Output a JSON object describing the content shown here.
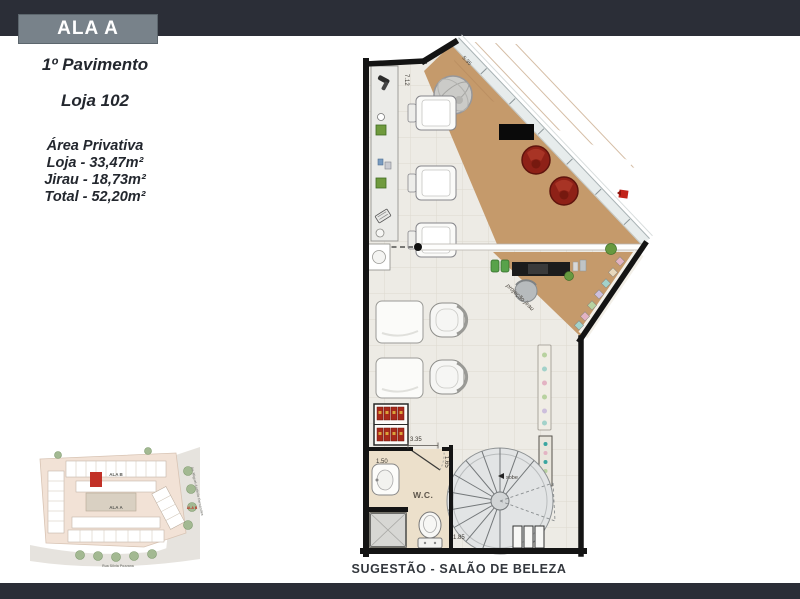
{
  "header": {
    "ala_label": "ALA A"
  },
  "info": {
    "pavimento": "1º Pavimento",
    "loja": "Loja 102",
    "area_title": "Área Privativa",
    "area_lines": [
      "Loja - 33,47m²",
      "Jirau - 18,73m²",
      "Total - 52,20m²"
    ]
  },
  "plan": {
    "dim_left_wall": "7.12",
    "dim_facade": "5.35",
    "dim_shelf": "3.35",
    "dim_wc_width": "1.50",
    "dim_wc_door": "1.65",
    "dim_stair": "1.85",
    "wc_label": "W.C.",
    "jirau_label": "projeção jirau",
    "stair_label": "sobe"
  },
  "caption": "SUGESTÃO - SALÃO DE BELEZA",
  "siteplan": {
    "wing_top": "ALA B",
    "wing_center": "ALA A",
    "wing_right": "ALA B",
    "street_bottom": "Rua Silvia Pozzana",
    "street_right": "Av. Miguel Antônio Fernandes"
  },
  "colors": {
    "navy_band": "#2b2e37",
    "ala_box_bg": "#78828a",
    "text_dark": "#23272e",
    "wood": "#c59a6b",
    "floor": "#edebe5",
    "wall": "#141414",
    "wc_floor": "#ece0cb",
    "chair_red": "#962519",
    "highlight_red": "#c23127"
  }
}
